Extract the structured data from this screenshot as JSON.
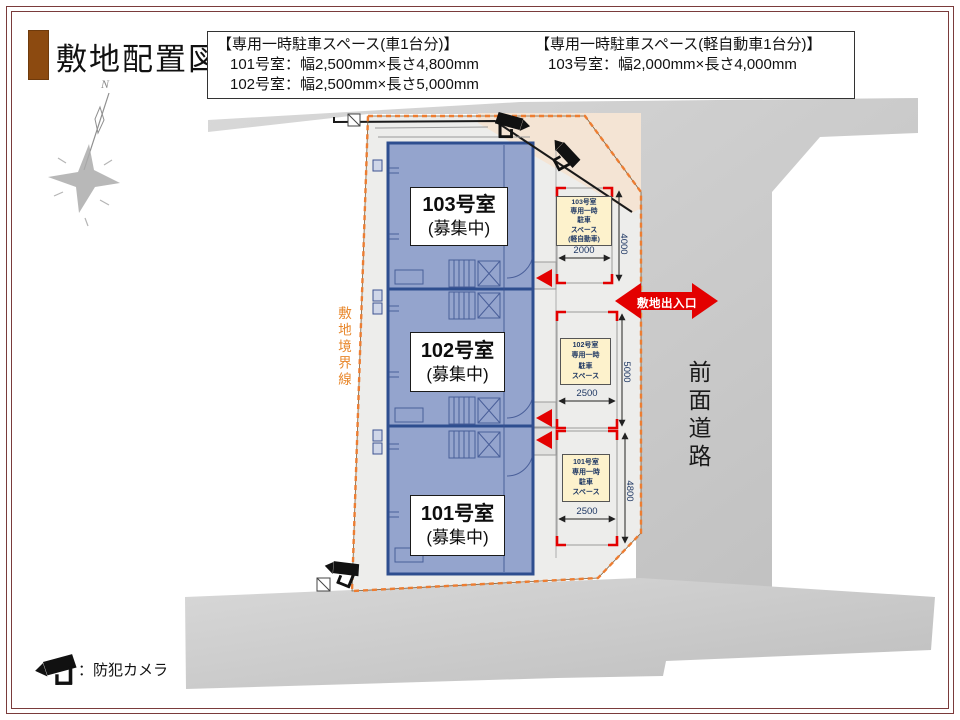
{
  "page": {
    "title": "敷地配置図",
    "compass_north": "N",
    "legend_camera": "：防犯カメラ"
  },
  "parking_notice": {
    "car": {
      "heading": "【専用一時駐車スペース(車1台分)】",
      "rows": [
        "101号室：幅2,500mm×長さ4,800mm",
        "102号室：幅2,500mm×長さ5,000mm"
      ]
    },
    "kei": {
      "heading": "【専用一時駐車スペース(軽自動車1台分)】",
      "rows": [
        "103号室：幅2,000mm×長さ4,000mm"
      ]
    }
  },
  "site": {
    "boundary_label": "敷地境界線",
    "front_road_label": "前面道路",
    "entrance_label": "敷地出入口",
    "units": [
      {
        "name": "103号室",
        "status": "(募集中)"
      },
      {
        "name": "102号室",
        "status": "(募集中)"
      },
      {
        "name": "101号室",
        "status": "(募集中)"
      }
    ],
    "parking_spaces": [
      {
        "label": "103号室\n専用一時\n駐車\nスペース\n(軽自動車)",
        "width_mm": "2000",
        "length_mm": "4000"
      },
      {
        "label": "102号室\n専用一時\n駐車\nスペース",
        "width_mm": "2500",
        "length_mm": "5000"
      },
      {
        "label": "101号室\n専用一時\n駐車\nスペース",
        "width_mm": "2500",
        "length_mm": "4800"
      }
    ]
  },
  "icons": {
    "camera": "cctv-camera-icon",
    "compass": "compass-rose-icon"
  },
  "colors": {
    "accent_red": "#E30000",
    "boundary_orange": "#ED7D31",
    "building_fill": "#8FA0CB",
    "building_border": "#2E4E8F",
    "parking_label_bg": "#FDF2CC",
    "dim_text": "#1F3864",
    "frame": "#7A3B3B",
    "title_bar": "#8C4A10",
    "road_gray": "#C9C9C9",
    "site_gray": "#EDEDEB",
    "beige": "#F4E4D4"
  }
}
